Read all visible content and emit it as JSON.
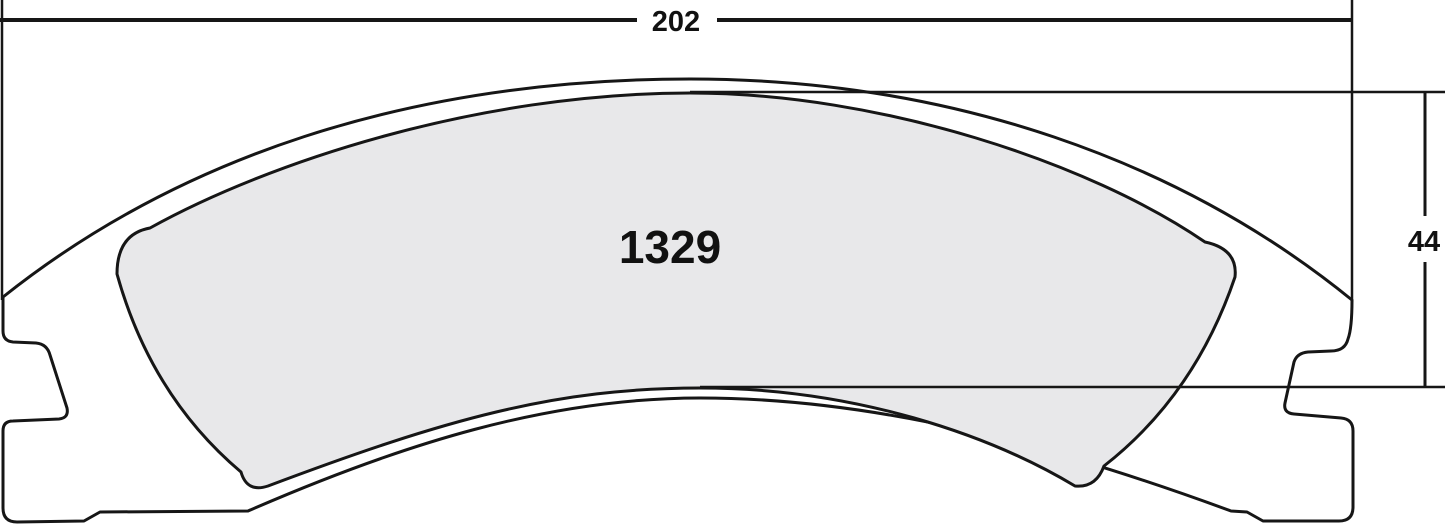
{
  "drawing": {
    "part_number": "1329",
    "dimensions": {
      "width_label": "202",
      "height_label": "44"
    }
  },
  "colors": {
    "line": "#161616",
    "friction_fill": "#e8e8ea",
    "plate_fill": "#ffffff",
    "background": "#ffffff"
  }
}
